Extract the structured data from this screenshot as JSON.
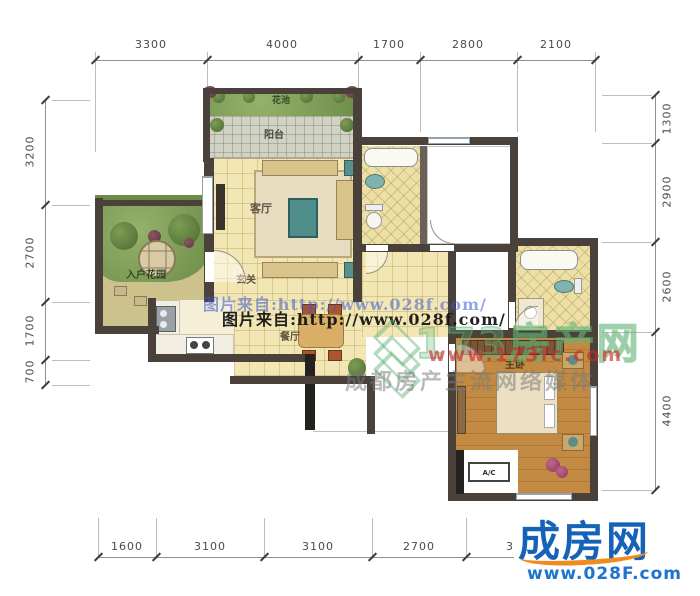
{
  "dimensions": {
    "top": [
      "3300",
      "4000",
      "1700",
      "2800",
      "2100"
    ],
    "left": [
      "3200",
      "2700",
      "1700",
      "700"
    ],
    "right": [
      "1300",
      "2900",
      "2600",
      "4400"
    ],
    "bottom": [
      "1600",
      "3100",
      "3100",
      "2700",
      "3"
    ]
  },
  "rooms": {
    "flower_bed": "花池",
    "balcony": "阳台",
    "living_room": "客厅",
    "foyer": "玄关",
    "entry_garden": "入户花园",
    "dining_room": "餐厅",
    "master_bedroom": "主卧",
    "ac_unit": "A/C"
  },
  "watermarks": {
    "source_line_1": "图片来自:http://www.028f.com/",
    "source_line_2": "图片来自:http://www.028f.com/",
    "brand_name": "173房产网",
    "brand_url": "www.173fc.com",
    "brand_slogan": "成都房产主流网络媒体"
  },
  "site_logo": {
    "name": "成房网",
    "url": "www.028F.com"
  },
  "colors": {
    "wall": "#4a423a",
    "floor_tile": "#f2e7b4",
    "logo_blue": "#1563b8",
    "logo_orange": "#f28b1e",
    "watermark_red": "#cc2a2a",
    "watermark_green": "#5fae73",
    "watermark_blue": "#3a5ad2"
  }
}
